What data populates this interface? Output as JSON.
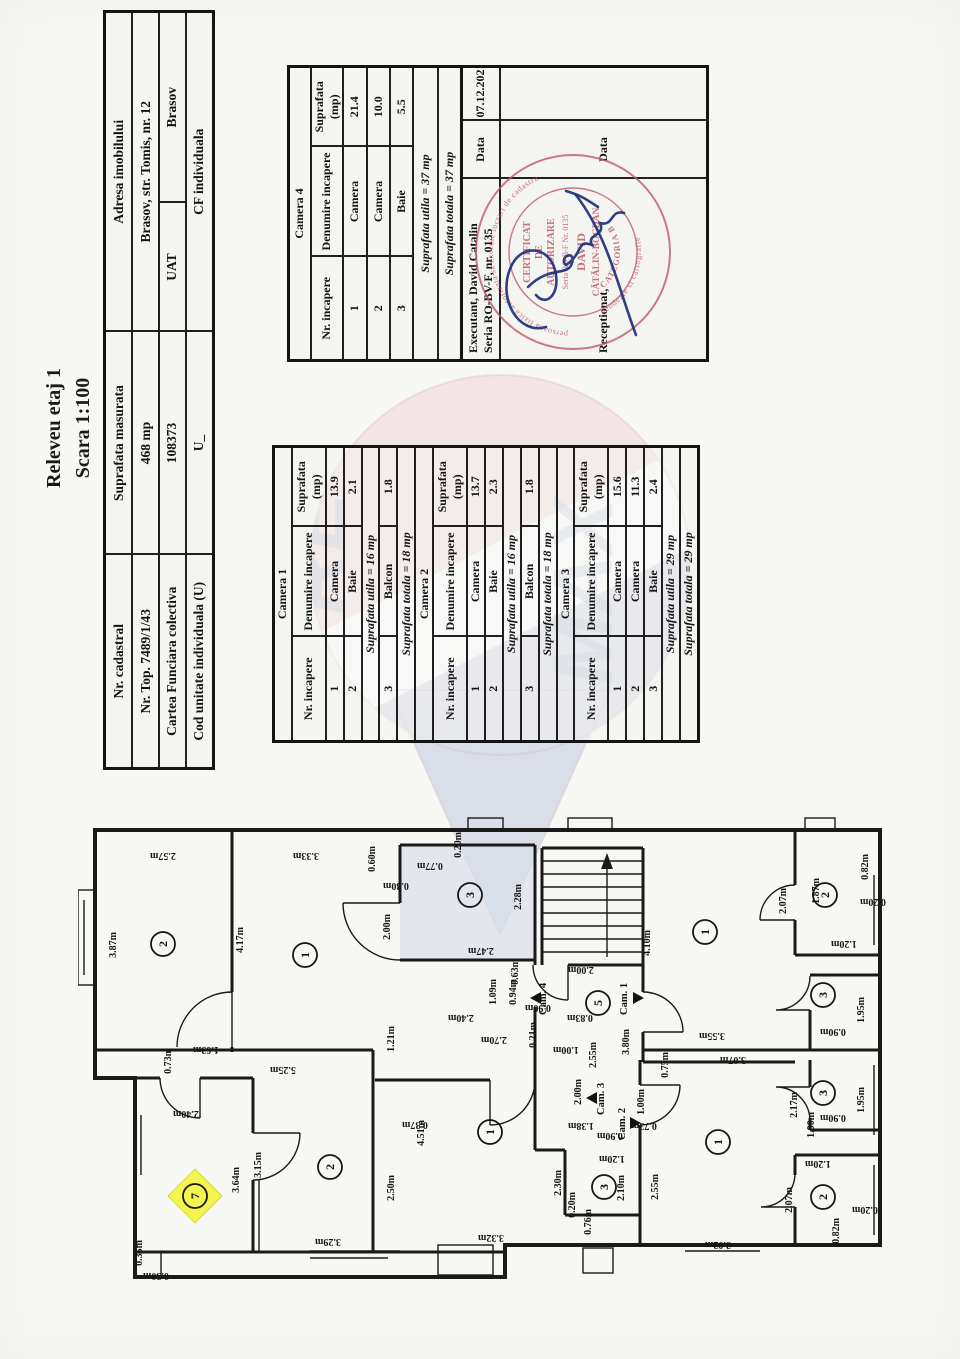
{
  "title": {
    "line1": "Releveu etaj 1",
    "line2": "Scara 1:100"
  },
  "info": {
    "r1c1": "Nr. cadastral",
    "r1c2": "Suprafata masurata",
    "r1c3": "Adresa imobilului",
    "r2c1": "Nr. Top. 7489/1/43",
    "r2c2": "468 mp",
    "r2c3": "Brasov, str. Tomis, nr. 12",
    "r3c1": "Cartea Funciara colectiva",
    "r3c2": "108373",
    "r3c3a": "UAT",
    "r3c3b": "Brasov",
    "r4c1": "Cod unitate individuala (U)",
    "r4c2": "U_",
    "r4c3": "CF individuala"
  },
  "headers": {
    "h1": "Nr. incapere",
    "h2": "Denumire incapere",
    "h3": "Suprafata (mp)"
  },
  "camera4": {
    "title": "Camera 4",
    "rows": [
      [
        "1",
        "Camera",
        "21.4"
      ],
      [
        "2",
        "Camera",
        "10.0"
      ],
      [
        "3",
        "Baie",
        "5.5"
      ]
    ],
    "utila": "Suprafata utila = 37 mp",
    "totala": "Suprafata totala = 37 mp",
    "executant_label": "Executant, David Catalin",
    "executant_serial": "Seria RO-BV-F, nr. 0135",
    "data_label": "Data",
    "data_value": "07.12.2021",
    "receptionat_label": "Receptionat,",
    "data_label2": "Data"
  },
  "camera1": {
    "title": "Camera 1",
    "rows": [
      [
        "1",
        "Camera",
        "13.9"
      ],
      [
        "2",
        "Baie",
        "2.1"
      ]
    ],
    "utila": "Suprafata utila = 16 mp",
    "balcon": [
      "3",
      "Balcon",
      "1.8"
    ],
    "totala": "Suprafata totala = 18 mp"
  },
  "camera2": {
    "title": "Camera 2",
    "rows": [
      [
        "1",
        "Camera",
        "13.7"
      ],
      [
        "2",
        "Baie",
        "2.3"
      ]
    ],
    "utila": "Suprafata utila = 16 mp",
    "balcon": [
      "3",
      "Balcon",
      "1.8"
    ],
    "totala": "Suprafata totala = 18 mp"
  },
  "camera3": {
    "title": "Camera 3",
    "rows": [
      [
        "1",
        "Camera",
        "15.6"
      ],
      [
        "2",
        "Camera",
        "11.3"
      ],
      [
        "3",
        "Baie",
        "2.4"
      ]
    ],
    "utila": "Suprafata utila = 29 mp",
    "totala": "Suprafata totala = 29 mp"
  },
  "stamp": {
    "arc_top": "persoana fizica autorizata sa execute lucrari de cadastru",
    "arc_bottom": "geodezie si cartografie",
    "l1": "CERTIFICAT",
    "l2": "DE",
    "l3": "AUTORIZARE",
    "l4": "Seria RO-B-F Nr. 0135",
    "l5": "DAVID",
    "l6": "CĂTĂLIN-BOGDAN",
    "l7": "CATEGORIA B"
  },
  "watermark": {
    "letters1": "RE",
    "letters2": "MAX",
    "pink": "#f0d9db",
    "blue": "#c6cfe2"
  },
  "plan": {
    "rooms": [
      {
        "n": "2",
        "x": 85,
        "y": 129
      },
      {
        "n": "1",
        "x": 227,
        "y": 140
      },
      {
        "n": "3",
        "x": 392,
        "y": 80
      },
      {
        "n": "1",
        "x": 627,
        "y": 117
      },
      {
        "n": "2",
        "x": 747,
        "y": 80
      },
      {
        "n": "3",
        "x": 745,
        "y": 180
      },
      {
        "n": "5",
        "x": 520,
        "y": 188
      },
      {
        "n": "3",
        "x": 745,
        "y": 278
      },
      {
        "n": "1",
        "x": 640,
        "y": 327
      },
      {
        "n": "2",
        "x": 745,
        "y": 382
      },
      {
        "n": "1",
        "x": 412,
        "y": 317
      },
      {
        "n": "3",
        "x": 526,
        "y": 372
      },
      {
        "n": "2",
        "x": 252,
        "y": 352
      },
      {
        "n": "7",
        "x": 117,
        "y": 381,
        "hl": true
      }
    ],
    "labels": [
      {
        "t": "3.87m",
        "x": 38,
        "y": 130,
        "r": -90
      },
      {
        "t": "2.57m",
        "x": 85,
        "y": 38,
        "r": 180
      },
      {
        "t": "3.33m",
        "x": 228,
        "y": 38,
        "r": 180
      },
      {
        "t": "4.17m",
        "x": 165,
        "y": 125,
        "r": -90
      },
      {
        "t": "0.60m",
        "x": 297,
        "y": 44,
        "r": -90
      },
      {
        "t": "0.30m",
        "x": 318,
        "y": 68,
        "r": 180
      },
      {
        "t": "2.00m",
        "x": 312,
        "y": 112,
        "r": -90
      },
      {
        "t": "0.77m",
        "x": 352,
        "y": 48,
        "r": 180
      },
      {
        "t": "0.20m",
        "x": 383,
        "y": 30,
        "r": -90
      },
      {
        "t": "2.28m",
        "x": 443,
        "y": 82,
        "r": -90
      },
      {
        "t": "2.47m",
        "x": 403,
        "y": 133,
        "r": 180
      },
      {
        "t": "4.10m",
        "x": 572,
        "y": 128,
        "r": -90
      },
      {
        "t": "3.55m",
        "x": 634,
        "y": 218,
        "r": 180
      },
      {
        "t": "2.07m",
        "x": 708,
        "y": 86,
        "r": -90
      },
      {
        "t": "1.87m",
        "x": 741,
        "y": 76,
        "r": -90
      },
      {
        "t": "0.82m",
        "x": 790,
        "y": 52,
        "r": -90
      },
      {
        "t": "0.20m",
        "x": 795,
        "y": 84,
        "r": 180
      },
      {
        "t": "1.20m",
        "x": 766,
        "y": 126,
        "r": 180
      },
      {
        "t": "1.95m",
        "x": 786,
        "y": 195,
        "r": -90
      },
      {
        "t": "0.90m",
        "x": 755,
        "y": 214,
        "r": 180
      },
      {
        "t": "3.07m",
        "x": 655,
        "y": 242,
        "r": 180
      },
      {
        "t": "0.75m",
        "x": 590,
        "y": 250,
        "r": -90
      },
      {
        "t": "2.17m",
        "x": 719,
        "y": 290,
        "r": -90
      },
      {
        "t": "1.95m",
        "x": 786,
        "y": 285,
        "r": -90
      },
      {
        "t": "0.90m",
        "x": 755,
        "y": 300,
        "r": 180
      },
      {
        "t": "2.55m",
        "x": 580,
        "y": 372,
        "r": -90
      },
      {
        "t": "3.02m",
        "x": 640,
        "y": 427,
        "r": 180
      },
      {
        "t": "2.07m",
        "x": 714,
        "y": 385,
        "r": -90
      },
      {
        "t": "0.82m",
        "x": 761,
        "y": 416,
        "r": -90
      },
      {
        "t": "1.20m",
        "x": 740,
        "y": 346,
        "r": 180
      },
      {
        "t": "0.20m",
        "x": 787,
        "y": 392,
        "r": 180
      },
      {
        "t": "4.51m",
        "x": 346,
        "y": 318,
        "r": -90
      },
      {
        "t": "2.50m",
        "x": 316,
        "y": 373,
        "r": -90
      },
      {
        "t": "3.32m",
        "x": 413,
        "y": 420,
        "r": 180
      },
      {
        "t": "0.37m",
        "x": 337,
        "y": 307,
        "r": 180
      },
      {
        "t": "2.30m",
        "x": 483,
        "y": 368,
        "r": -90
      },
      {
        "t": "2.10m",
        "x": 546,
        "y": 373,
        "r": -90
      },
      {
        "t": "0.76m",
        "x": 513,
        "y": 407,
        "r": -90
      },
      {
        "t": "1.20m",
        "x": 534,
        "y": 341,
        "r": 180
      },
      {
        "t": "0.20m",
        "x": 497,
        "y": 390,
        "r": -90
      },
      {
        "t": "3.64m",
        "x": 161,
        "y": 365,
        "r": -90
      },
      {
        "t": "3.15m",
        "x": 183,
        "y": 350,
        "r": -90
      },
      {
        "t": "3.29m",
        "x": 250,
        "y": 424,
        "r": 180
      },
      {
        "t": "2.40m",
        "x": 108,
        "y": 296,
        "r": 180
      },
      {
        "t": "0.35m",
        "x": 64,
        "y": 438,
        "r": -90
      },
      {
        "t": "0.30m",
        "x": 78,
        "y": 458,
        "r": 180
      },
      {
        "t": "5.25m",
        "x": 205,
        "y": 252,
        "r": 180
      },
      {
        "t": "1.63m",
        "x": 128,
        "y": 232,
        "r": 180
      },
      {
        "t": "0.73m",
        "x": 93,
        "y": 246,
        "r": -90
      },
      {
        "t": "1.21m",
        "x": 316,
        "y": 224,
        "r": -90
      },
      {
        "t": "2.40m",
        "x": 383,
        "y": 200,
        "r": 180
      },
      {
        "t": "2.70m",
        "x": 416,
        "y": 222,
        "r": 180
      },
      {
        "t": "0.21m",
        "x": 458,
        "y": 220,
        "r": -90
      },
      {
        "t": "1.00m",
        "x": 488,
        "y": 232,
        "r": 180
      },
      {
        "t": "2.00m",
        "x": 503,
        "y": 152,
        "r": 180
      },
      {
        "t": "0.63m",
        "x": 440,
        "y": 157,
        "r": -90
      },
      {
        "t": "0.94m",
        "x": 438,
        "y": 177,
        "r": -90
      },
      {
        "t": "0.90m",
        "x": 460,
        "y": 190,
        "r": 180
      },
      {
        "t": "0.83m",
        "x": 502,
        "y": 200,
        "r": 180
      },
      {
        "t": "1.09m",
        "x": 418,
        "y": 177,
        "r": -90
      },
      {
        "t": "2.55m",
        "x": 518,
        "y": 240,
        "r": -90
      },
      {
        "t": "3.80m",
        "x": 551,
        "y": 227,
        "r": -90
      },
      {
        "t": "2.00m",
        "x": 503,
        "y": 277,
        "r": -90
      },
      {
        "t": "1.38m",
        "x": 503,
        "y": 308,
        "r": 180
      },
      {
        "t": "0.90m",
        "x": 532,
        "y": 318,
        "r": 180
      },
      {
        "t": "1.00m",
        "x": 566,
        "y": 287,
        "r": -90
      },
      {
        "t": "0.73m",
        "x": 566,
        "y": 308,
        "r": 180
      },
      {
        "t": "1.00m",
        "x": 736,
        "y": 310,
        "r": -90
      }
    ],
    "cams": [
      {
        "t": "Cam. 4",
        "x": 468,
        "y": 200,
        "tx": 452,
        "ty": 183,
        "d": 0
      },
      {
        "t": "Cam. 1",
        "x": 549,
        "y": 200,
        "tx": 566,
        "ty": 183,
        "d": 180
      },
      {
        "t": "Cam. 3",
        "x": 526,
        "y": 300,
        "tx": 508,
        "ty": 283,
        "d": 0
      },
      {
        "t": "Cam. 2",
        "x": 547,
        "y": 325,
        "tx": 563,
        "ty": 308,
        "d": 180
      }
    ]
  }
}
